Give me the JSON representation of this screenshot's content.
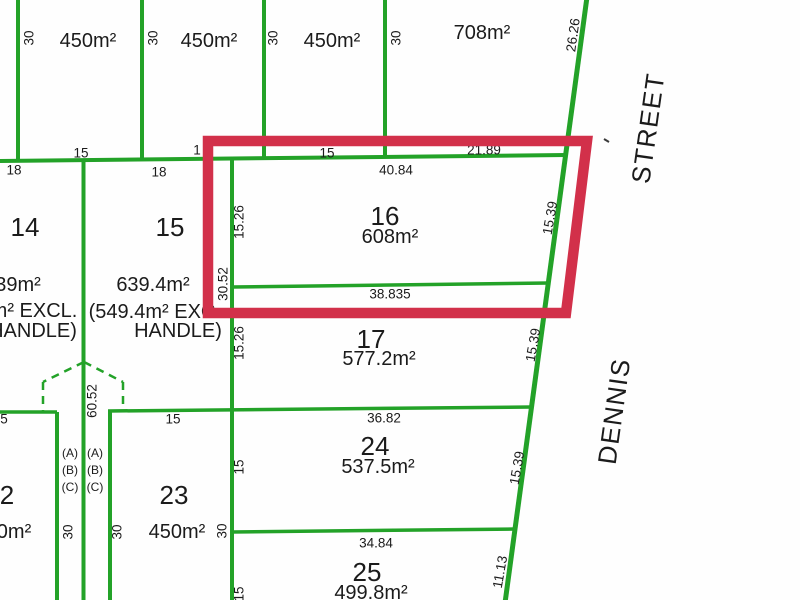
{
  "colors": {
    "line_green": "#23a228",
    "highlight_red": "#d2304a",
    "text": "#1b1b1b",
    "background": "#fefefe"
  },
  "street": {
    "name_dennis": "DENNIS",
    "name_street": "STREET",
    "dim_top": "26.26"
  },
  "top_row": {
    "lot1": {
      "depth": "30",
      "area": "450m²",
      "frontage": "15"
    },
    "lot2": {
      "depth": "30",
      "area": "450m²",
      "frontage_fragment": "1"
    },
    "lot3": {
      "depth": "30",
      "area": "450m²",
      "frontage": "15"
    },
    "lot4": {
      "depth": "30",
      "area": "708m²",
      "frontage": "21.89"
    }
  },
  "boundary": {
    "seg_a": "18",
    "seg_b": "18"
  },
  "lot14": {
    "number": "14",
    "area_fragment": "39m²",
    "excl_fragment": "m² EXCL.",
    "handle_fragment": "HANDLE)"
  },
  "lot15": {
    "number": "15",
    "area": "639.4m²",
    "excl_note": "(549.4m² EXC",
    "handle_note": "HANDLE)",
    "side_dim": "30.52"
  },
  "lot16": {
    "number": "16",
    "area": "608m²",
    "top": "40.84",
    "bottom": "38.835",
    "left": "15.26",
    "right": "15.39"
  },
  "lot17": {
    "number": "17",
    "area": "577.2m²",
    "left": "15.26",
    "right": "15.39"
  },
  "handle_strip": {
    "length": "60.52",
    "left_col": [
      "(A)",
      "(B)",
      "(C)"
    ],
    "right_col": [
      "(A)",
      "(B)",
      "(C)"
    ],
    "left_depth": "30",
    "right_depth": "30"
  },
  "lot22": {
    "number_fragment": "2",
    "area_fragment": "0m²",
    "frontage_fragment": "5"
  },
  "lot23": {
    "number": "23",
    "area": "450m²",
    "frontage": "15",
    "side_right": "30"
  },
  "lot24": {
    "number": "24",
    "area": "537.5m²",
    "top": "36.82",
    "left": "15",
    "right": "15.39"
  },
  "lot25": {
    "number": "25",
    "area": "499.8m²",
    "top": "34.84",
    "left": "15",
    "right": "11.13"
  }
}
